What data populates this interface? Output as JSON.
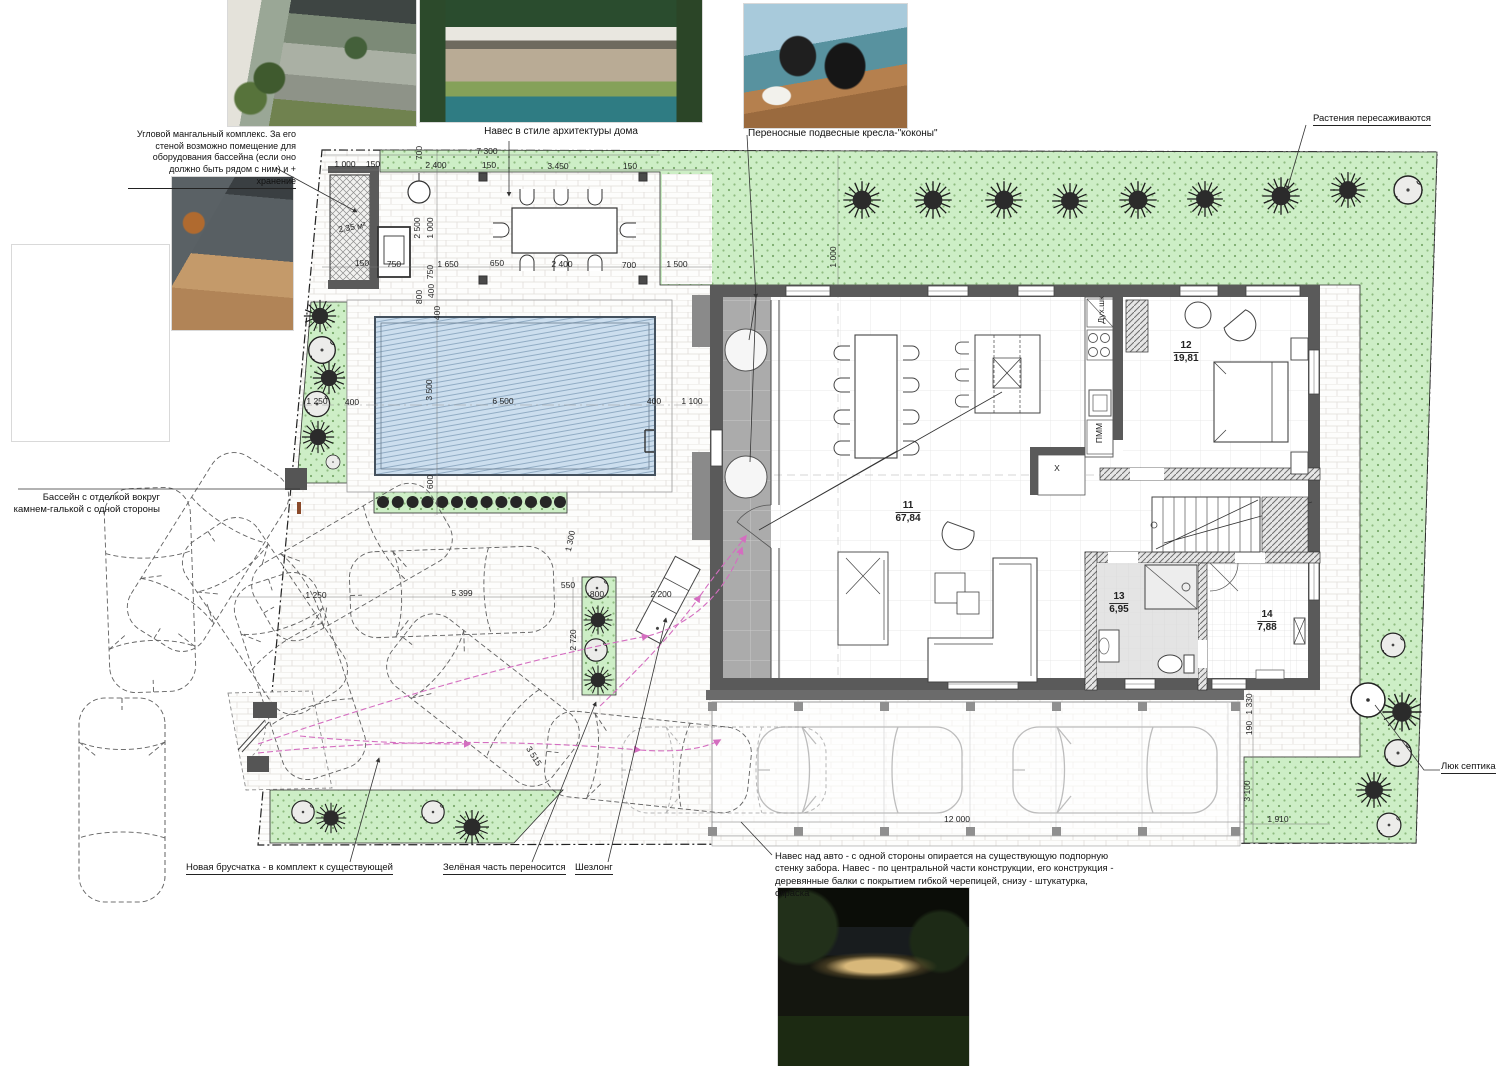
{
  "colors": {
    "green_fill": "#cdeec6",
    "pool_fill": "#ccdeee",
    "wall_gray": "#5a5a5a",
    "route_magenta": "#d46ec0"
  },
  "annotations": {
    "mangal": "Угловой мангальный комплекс. За его стеной возможно помещение для оборудования бассейна (если оно должно быть рядом с ним) и + хранение",
    "pavilion_caption": "Навес в стиле архитектуры дома",
    "cocoon_caption": "Переносные подвесные кресла-\"коконы\"",
    "pool_caption": "Бассейн с отделкой вокруг камнем-галькой с одной стороны",
    "plants": "Растения пересаживаются",
    "septic": "Люк септика",
    "paving": "Новая брусчатка - в комплект к существующей",
    "green_moved": "Зелёная часть переносится",
    "lounger": "Шезлонг",
    "carport": "Навес над авто - с одной стороны опирается на существующую подпорную стенку забора. Навес - по центральной части конструкции, его конструкция - деревянные балки с покрытием гибкой черепицей, снизу - штукатурка, окраска"
  },
  "rooms": [
    {
      "num": "11",
      "area": "67,84",
      "x": 908,
      "y": 512
    },
    {
      "num": "12",
      "area": "19,81",
      "x": 1186,
      "y": 352
    },
    {
      "num": "13",
      "area": "6,95",
      "x": 1119,
      "y": 603
    },
    {
      "num": "14",
      "area": "7,88",
      "x": 1267,
      "y": 621
    }
  ],
  "dims": [
    {
      "t": "7 300",
      "x": 487,
      "y": 151
    },
    {
      "t": "700",
      "x": 419,
      "y": 153,
      "rot": -90
    },
    {
      "t": "1 000",
      "x": 345,
      "y": 164
    },
    {
      "t": "150",
      "x": 373,
      "y": 164
    },
    {
      "t": "2 400",
      "x": 436,
      "y": 165
    },
    {
      "t": "150",
      "x": 489,
      "y": 165
    },
    {
      "t": "3 450",
      "x": 558,
      "y": 166
    },
    {
      "t": "150",
      "x": 630,
      "y": 166
    },
    {
      "t": "2,35 м²",
      "x": 352,
      "y": 227,
      "rot": -10
    },
    {
      "t": "2 500",
      "x": 417,
      "y": 228,
      "rot": -90
    },
    {
      "t": "1 000",
      "x": 430,
      "y": 228,
      "rot": -90
    },
    {
      "t": "150",
      "x": 362,
      "y": 263
    },
    {
      "t": "750",
      "x": 394,
      "y": 264
    },
    {
      "t": "1 650",
      "x": 448,
      "y": 264
    },
    {
      "t": "650",
      "x": 497,
      "y": 263
    },
    {
      "t": "2 400",
      "x": 562,
      "y": 264
    },
    {
      "t": "700",
      "x": 629,
      "y": 265
    },
    {
      "t": "1 500",
      "x": 677,
      "y": 264
    },
    {
      "t": "750",
      "x": 430,
      "y": 272,
      "rot": -90
    },
    {
      "t": "800",
      "x": 419,
      "y": 297,
      "rot": -90
    },
    {
      "t": "400",
      "x": 431,
      "y": 291,
      "rot": -90
    },
    {
      "t": "400",
      "x": 437,
      "y": 313,
      "rot": -90
    },
    {
      "t": "1 000",
      "x": 833,
      "y": 257,
      "rot": -90
    },
    {
      "t": "1 250",
      "x": 317,
      "y": 401
    },
    {
      "t": "400",
      "x": 352,
      "y": 402
    },
    {
      "t": "3 500",
      "x": 429,
      "y": 390,
      "rot": -90
    },
    {
      "t": "6 500",
      "x": 503,
      "y": 401
    },
    {
      "t": "400",
      "x": 654,
      "y": 401
    },
    {
      "t": "1 100",
      "x": 692,
      "y": 401
    },
    {
      "t": "600",
      "x": 430,
      "y": 482,
      "rot": -90
    },
    {
      "t": "1 250",
      "x": 316,
      "y": 595
    },
    {
      "t": "5 399",
      "x": 462,
      "y": 593
    },
    {
      "t": "1 300",
      "x": 570,
      "y": 541,
      "rot": -78
    },
    {
      "t": "550",
      "x": 568,
      "y": 585
    },
    {
      "t": "800",
      "x": 597,
      "y": 594
    },
    {
      "t": "2 720",
      "x": 573,
      "y": 640,
      "rot": -90
    },
    {
      "t": "2 200",
      "x": 661,
      "y": 594
    },
    {
      "t": "3 515",
      "x": 534,
      "y": 756,
      "rot": 58
    },
    {
      "t": "12 000",
      "x": 957,
      "y": 819
    },
    {
      "t": "1 330",
      "x": 1249,
      "y": 704,
      "rot": -90
    },
    {
      "t": "190",
      "x": 1249,
      "y": 728,
      "rot": -90
    },
    {
      "t": "3 100",
      "x": 1247,
      "y": 791,
      "rot": -90
    },
    {
      "t": "1 910",
      "x": 1278,
      "y": 819
    },
    {
      "t": "X",
      "x": 1057,
      "y": 468
    },
    {
      "t": "ПММ",
      "x": 1099,
      "y": 433,
      "rot": -90
    },
    {
      "t": "Дух.шк",
      "x": 1101,
      "y": 310,
      "rot": -90
    }
  ]
}
